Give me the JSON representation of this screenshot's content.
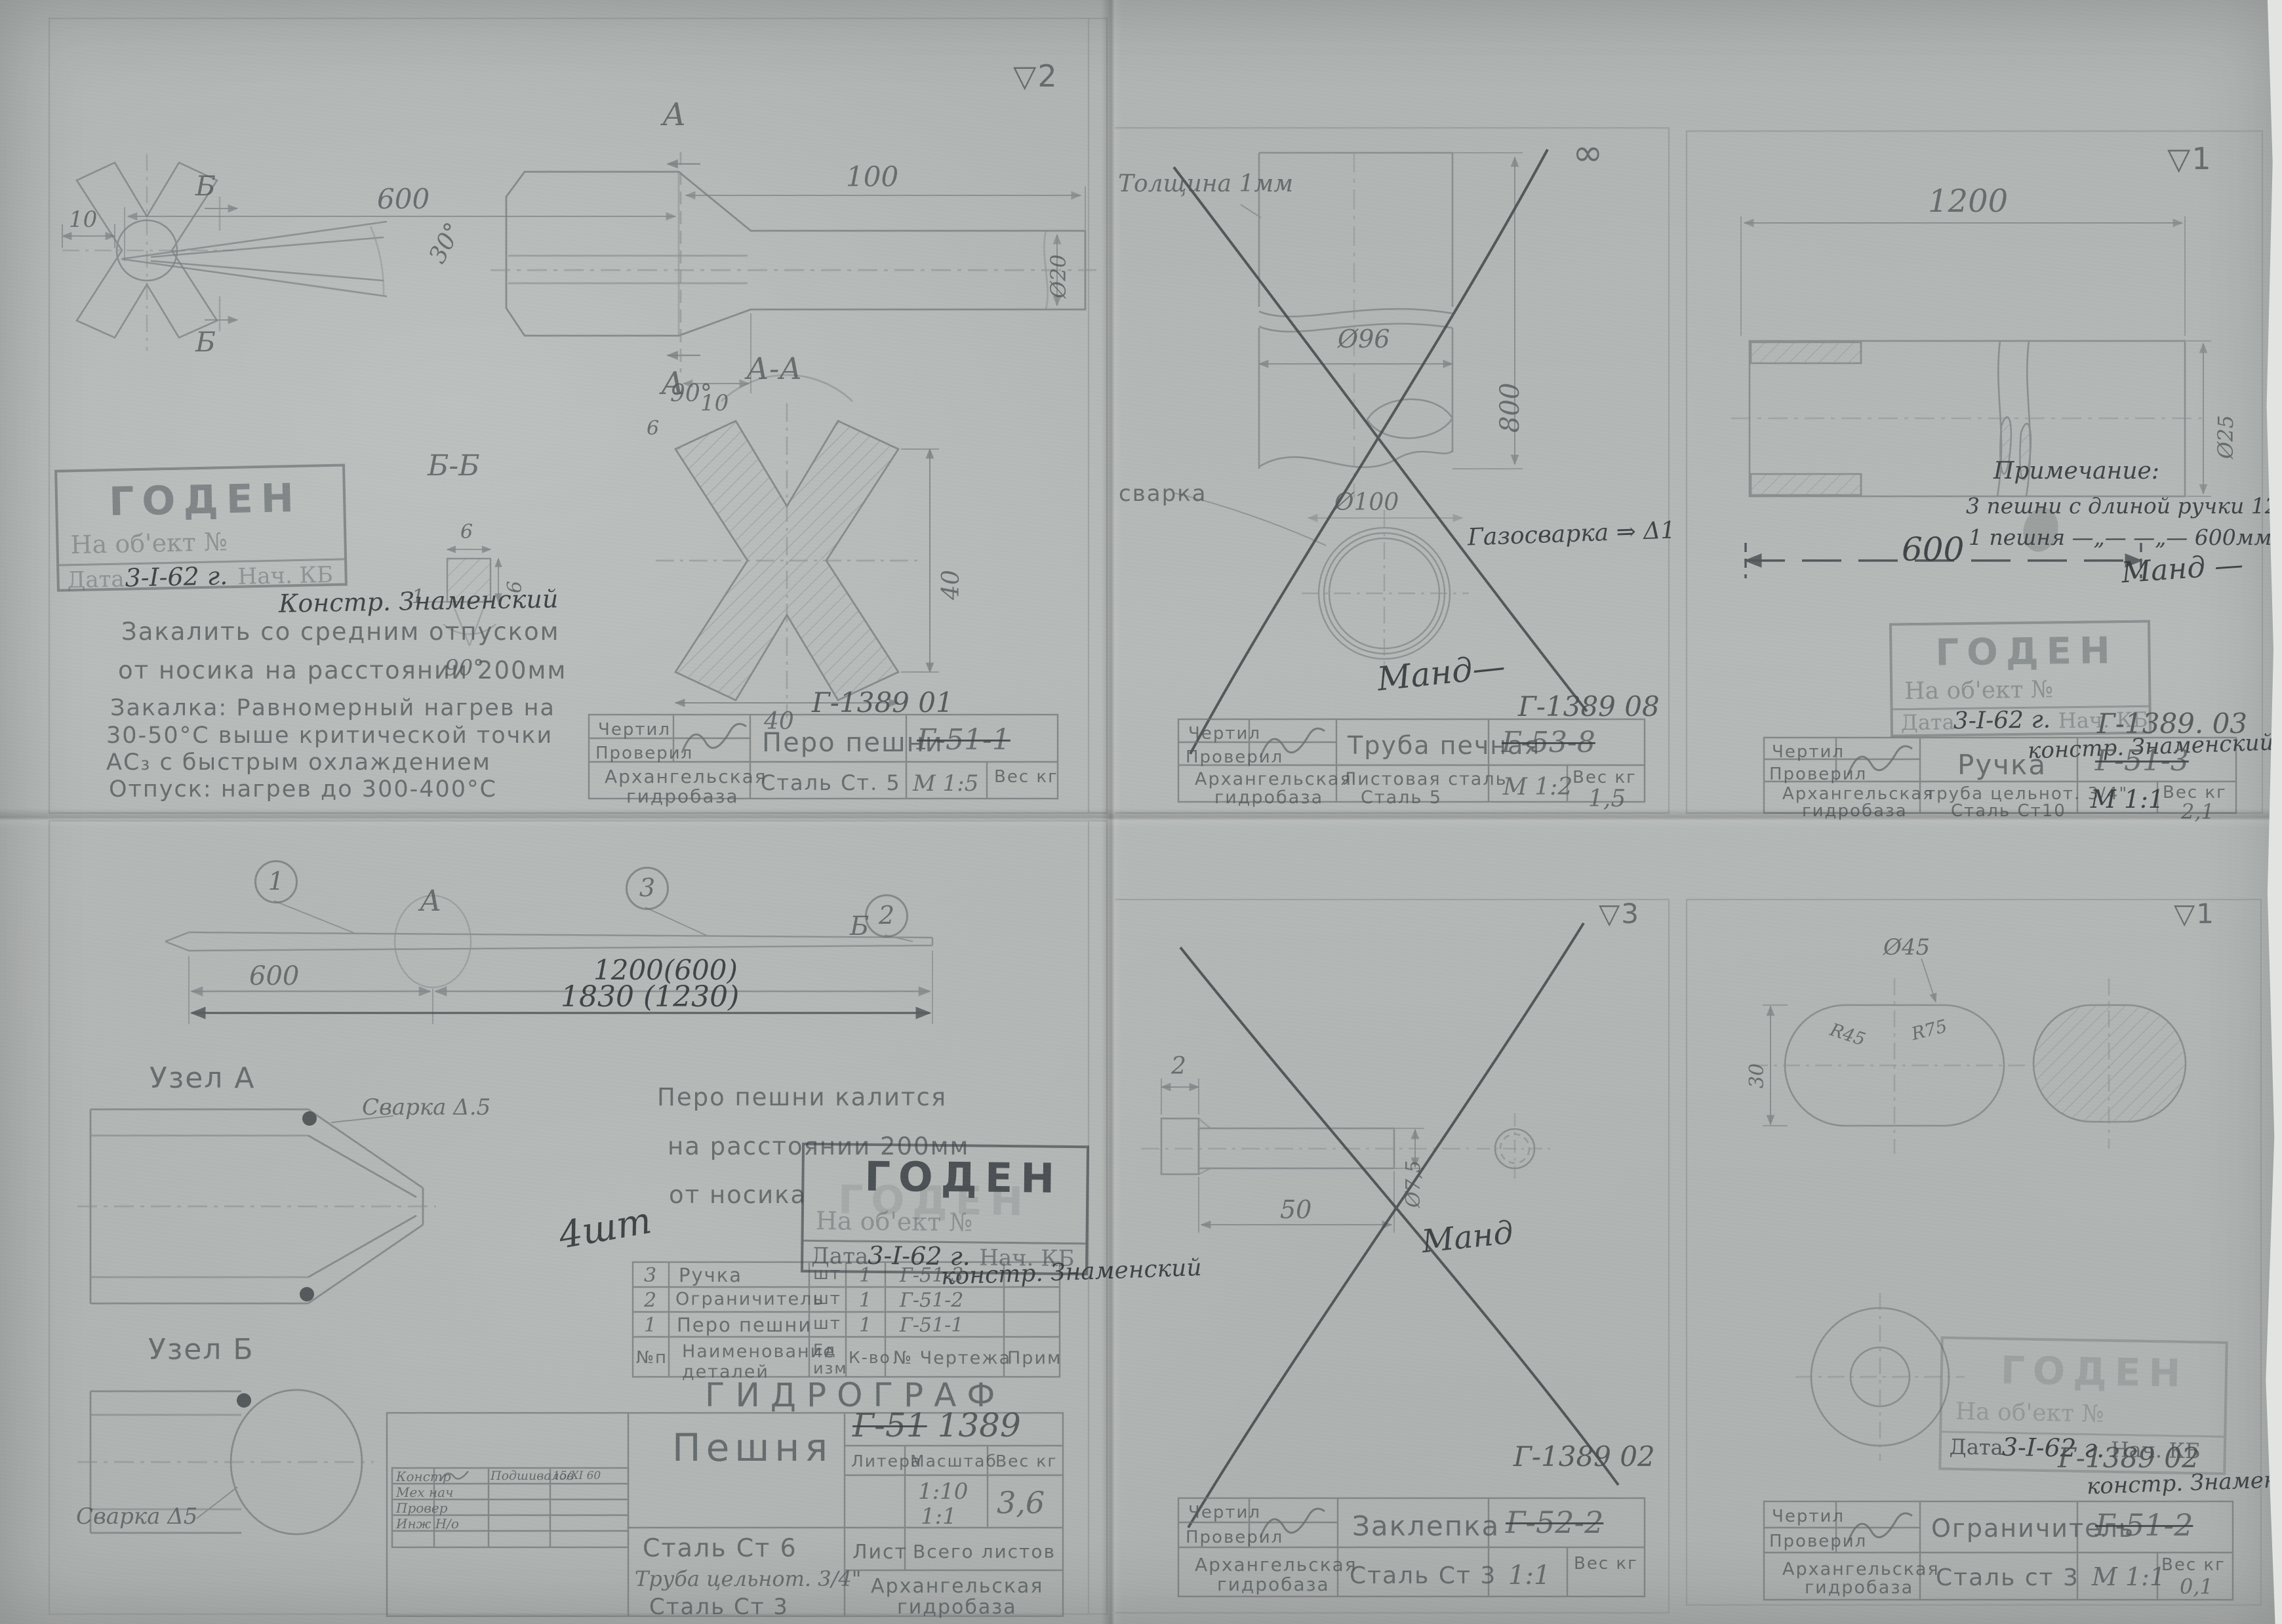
{
  "colors": {
    "paper": "#b4b8b6",
    "pencil": "#52585a",
    "dark_pencil": "#363b3e",
    "stamp_ink": "#545a5e"
  },
  "common": {
    "chertil": "Чертил",
    "proveril": "Проверил",
    "org1": "Архангельская",
    "org2": "гидробаза",
    "ves_kg": "Вес кг",
    "goden": "ГОДЕН",
    "na_object": "На об'ект №",
    "data_label": "Дата",
    "date": "3-I-62 г.",
    "nach_kb": "Нач. КБ",
    "konstr_sign": "констр. Знаменский"
  },
  "tl": {
    "finish_mark": "▽2",
    "doc_no": "Г-1389 01",
    "part_name": "Перо пешни",
    "old_code": "Г-51-1",
    "material": "Сталь Ст. 5",
    "scale": "М 1:5",
    "konstr_note": "Констр. Знаменский",
    "notes": [
      "Закалить  со  средним  отпуском",
      "от  носика  на  расстоянии  200мм",
      "Закалка: Равномерный нагрев на",
      "30-50°С  выше  критической  точки",
      "АС₃  с  быстрым  охлаждением",
      "Отпуск:  нагрев  до  300-400°С"
    ],
    "dims": {
      "d600": "600",
      "d100": "100",
      "d10a": "10",
      "d10b": "10",
      "dia20": "Ø20",
      "a1": "А",
      "a2": "А",
      "b1": "Б",
      "b2": "Б",
      "sec_aa": "А-А",
      "sec_bb": "Б-Б",
      "ang30": "30°",
      "ang90_aa": "90°",
      "ang90_bb": "90°",
      "bb6a": "6",
      "bb6b": "6",
      "bb1": "1",
      "aa6": "6",
      "aa40r": "40",
      "aa40b": "40"
    }
  },
  "tm": {
    "surface_mark": "∞",
    "thickness": "Толщина 1мм",
    "dia96": "Ø96",
    "d800": "800",
    "svarka": "сварка",
    "dia100": "Ø100",
    "gas": "Газосварка ⇒ Δ1",
    "sign": "Манд—",
    "doc_no": "Г-1389 08",
    "part_name": "Труба печная",
    "old_code": "Г-53-8",
    "mat1": "Листовая сталь",
    "mat2": "Сталь 5",
    "scale": "М 1:2",
    "weight": "1,5"
  },
  "tr": {
    "finish_mark": "▽1",
    "d1200": "1200",
    "d600": "600",
    "dia25": "Ø25",
    "note_title": "Примечание:",
    "note1": "3 пешни с длиной ручки 1200мм",
    "note2": "1 пешня  —„—   —„—   600мм.",
    "sign": "Манд —",
    "doc_no": "Г-1389. 03",
    "part_name": "Ручка",
    "old_code": "Г-51-3",
    "mat1": "труба цельнот. 3/4\"",
    "mat2": "Сталь Ст10",
    "scale": "М 1:1",
    "weight": "2,1"
  },
  "bl": {
    "balloon1": "1",
    "balloon2": "2",
    "balloon3": "3",
    "node_a": "А",
    "node_b": "Б",
    "d600": "600",
    "d1200": "1200(600)",
    "d1830": "1830 (1230)",
    "uzel_a": "Узел А",
    "uzel_b": "Узел Б",
    "svarka_a": "Сварка Δ.5",
    "svarka_b": "Сварка Δ5",
    "qty": "4шт",
    "notes": [
      "Перо пешни калится",
      "на расстоянии  200мм",
      "от  носика"
    ],
    "gidrograf": "ГИДРОГРАФ",
    "doc_old": "Г-51",
    "doc_no": "1389",
    "part_name": "Пешня",
    "parts_header": [
      "№п",
      "Наименование деталей",
      "Ед изм",
      "К-во",
      "№ Чертежа",
      "Прим"
    ],
    "parts_rows": [
      [
        "3",
        "Ручка",
        "шт",
        "1",
        "Г-51-3"
      ],
      [
        "2",
        "Ограничитель",
        "шт",
        "1",
        "Г-51-2"
      ],
      [
        "1",
        "Перо пешни",
        "шт",
        "1",
        "Г-51-1"
      ]
    ],
    "tb": {
      "litera": "Литера",
      "masshtab": "Масштаб",
      "scale1": "1:10",
      "scale2": "1:1",
      "weight": "3,6",
      "list": "Лист",
      "sheets": "Всего листов",
      "mat1": "Сталь Ст 6",
      "mat2": "Труба цельнот. 3/4\"",
      "mat3": "Сталь Ст 3"
    },
    "sig_rows": [
      "Констр",
      "Мех нач",
      "Провер",
      "Инж Н/о"
    ],
    "sig_name": "Подшивалов",
    "sig_date": "15/XI 60"
  },
  "bm": {
    "finish_mark": "▽3",
    "d2": "2",
    "d50": "50",
    "dia75": "Ø7,5",
    "sign": "Манд",
    "doc_no": "Г-1389 02",
    "part_name": "Заклепка",
    "old_code": "Г-52-2",
    "material": "Сталь Ст 3",
    "scale": "1:1"
  },
  "br": {
    "finish_mark": "▽1",
    "dia45": "Ø45",
    "r45": "R45",
    "r75": "R75",
    "d30": "30",
    "doc_no": "Г-1389 02",
    "part_name": "Ограничитель",
    "old_code": "Г-51-2",
    "material": "Сталь ст 3",
    "scale": "М 1:1",
    "weight": "0,1"
  }
}
